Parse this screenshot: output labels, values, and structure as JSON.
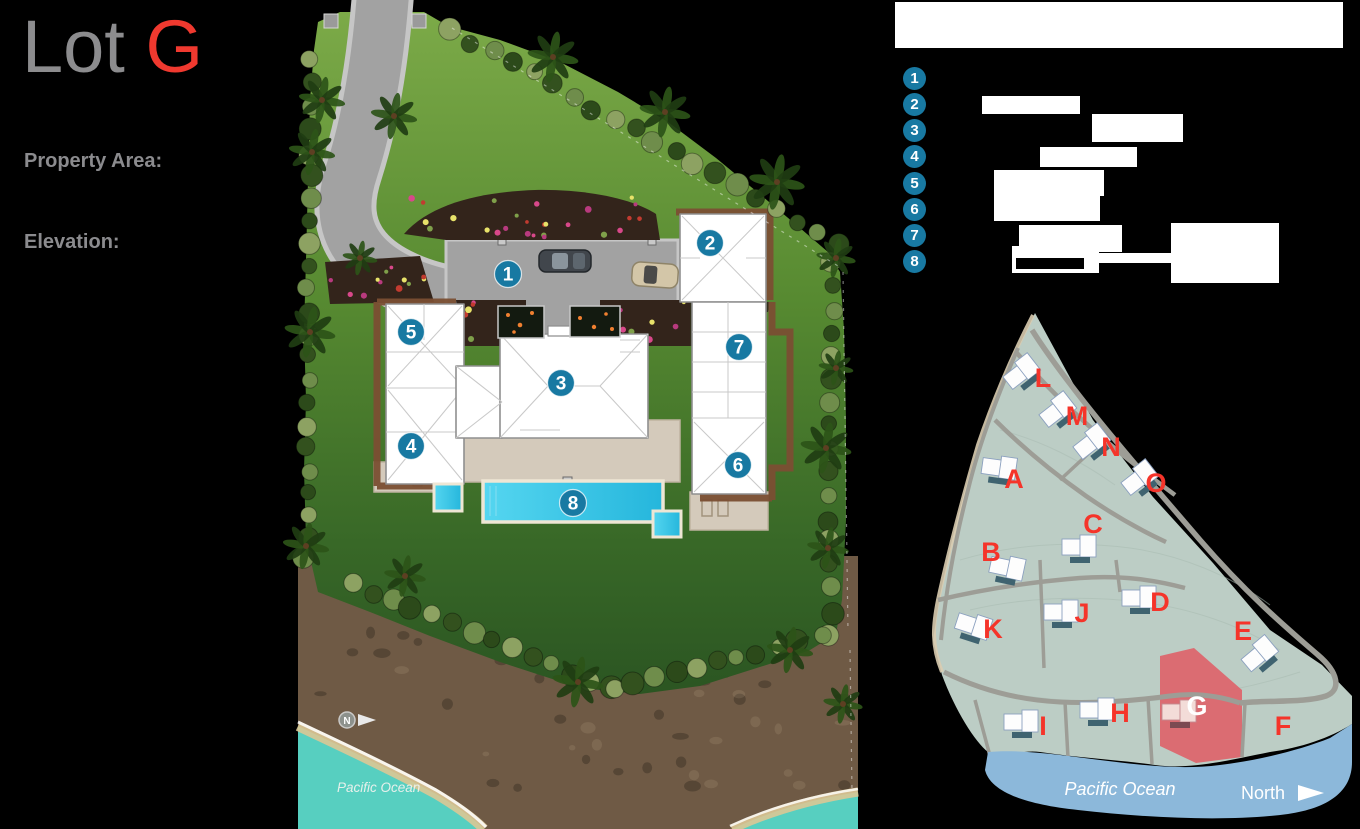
{
  "header": {
    "title_prefix": "Lot",
    "title_lot": "G",
    "property_area_label": "Property Area:",
    "elevation_label": "Elevation:"
  },
  "legend": {
    "items": [
      {
        "number": "1"
      },
      {
        "number": "2"
      },
      {
        "number": "3"
      },
      {
        "number": "4"
      },
      {
        "number": "5"
      },
      {
        "number": "6"
      },
      {
        "number": "7"
      },
      {
        "number": "8"
      }
    ]
  },
  "site_plan": {
    "markers": [
      {
        "number": "1",
        "x": 508,
        "y": 274
      },
      {
        "number": "2",
        "x": 710,
        "y": 243
      },
      {
        "number": "3",
        "x": 561,
        "y": 383
      },
      {
        "number": "4",
        "x": 411,
        "y": 446
      },
      {
        "number": "5",
        "x": 411,
        "y": 332
      },
      {
        "number": "6",
        "x": 738,
        "y": 465
      },
      {
        "number": "7",
        "x": 739,
        "y": 347
      },
      {
        "number": "8",
        "x": 573,
        "y": 503
      }
    ],
    "north_label": "N",
    "ocean_label": "Pacific Ocean"
  },
  "inset_map": {
    "highlighted_lot": "G",
    "ocean_label": "Pacific Ocean",
    "north_label": "North",
    "lots": [
      {
        "letter": "L",
        "x": 1043,
        "y": 387,
        "building": true,
        "bx": 1022,
        "by": 372,
        "angle": -38,
        "highlighted": false
      },
      {
        "letter": "M",
        "x": 1077,
        "y": 425,
        "building": true,
        "bx": 1058,
        "by": 410,
        "angle": -38,
        "highlighted": false
      },
      {
        "letter": "N",
        "x": 1111,
        "y": 456,
        "building": true,
        "bx": 1092,
        "by": 442,
        "angle": -38,
        "highlighted": false
      },
      {
        "letter": "O",
        "x": 1156,
        "y": 492,
        "building": true,
        "bx": 1140,
        "by": 478,
        "angle": -38,
        "highlighted": false
      },
      {
        "letter": "A",
        "x": 1014,
        "y": 488,
        "building": true,
        "bx": 1000,
        "by": 468,
        "angle": 8,
        "highlighted": false
      },
      {
        "letter": "B",
        "x": 991,
        "y": 561,
        "building": true,
        "bx": 1008,
        "by": 568,
        "angle": 12,
        "highlighted": false
      },
      {
        "letter": "C",
        "x": 1093,
        "y": 533,
        "building": true,
        "bx": 1080,
        "by": 547,
        "angle": 0,
        "highlighted": false
      },
      {
        "letter": "J",
        "x": 1082,
        "y": 622,
        "building": true,
        "bx": 1062,
        "by": 612,
        "angle": 0,
        "highlighted": false
      },
      {
        "letter": "D",
        "x": 1160,
        "y": 611,
        "building": true,
        "bx": 1140,
        "by": 598,
        "angle": 0,
        "highlighted": false
      },
      {
        "letter": "K",
        "x": 993,
        "y": 638,
        "building": true,
        "bx": 974,
        "by": 626,
        "angle": 18,
        "highlighted": false
      },
      {
        "letter": "E",
        "x": 1243,
        "y": 640,
        "building": true,
        "bx": 1260,
        "by": 654,
        "angle": -40,
        "highlighted": false
      },
      {
        "letter": "I",
        "x": 1043,
        "y": 735,
        "building": true,
        "bx": 1022,
        "by": 722,
        "angle": 0,
        "highlighted": false
      },
      {
        "letter": "H",
        "x": 1120,
        "y": 722,
        "building": true,
        "bx": 1098,
        "by": 710,
        "angle": 0,
        "highlighted": false
      },
      {
        "letter": "G",
        "x": 1197,
        "y": 715,
        "building": true,
        "bx": 1180,
        "by": 712,
        "angle": 0,
        "highlighted": true
      },
      {
        "letter": "F",
        "x": 1283,
        "y": 735,
        "building": false,
        "bx": 0,
        "by": 0,
        "angle": 0,
        "highlighted": false
      }
    ]
  },
  "colors": {
    "marker_teal": "#1879a2",
    "lot_letter_red": "#f5342a",
    "lot_highlight": "#df5f66",
    "title_gray": "#8c8c8e",
    "title_red": "#f0392f"
  }
}
